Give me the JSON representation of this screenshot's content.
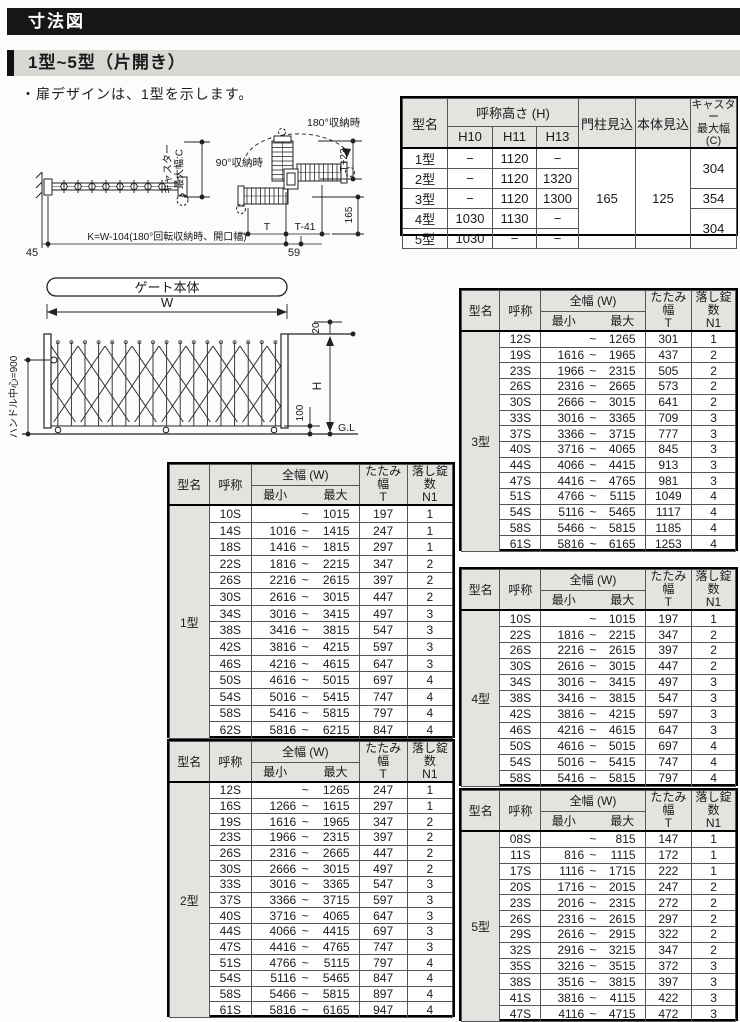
{
  "page": {
    "title": "寸法図",
    "subtitle": "1型~5型（片開き）",
    "note": "・扉デザインは、1型を示します。"
  },
  "plan_view": {
    "caster_l1": "キャスター",
    "caster_l2": "最大幅:C",
    "deg180": "180°収納時",
    "deg90": "90°収納時",
    "t_plus23": "T+23",
    "dim_165": "165",
    "dim_t": "T",
    "dim_t41": "T-41",
    "dim_59": "59",
    "dim_45": "45",
    "k_formula": "K=W-104(180°回転収納時、開口幅)"
  },
  "gate_view": {
    "title": "ゲート本体",
    "w": "W",
    "dim_20": "20",
    "h": "H",
    "dim_100": "100",
    "gl": "G.L",
    "handle_center": "ハンドル中心=900"
  },
  "spec_table": {
    "headers": {
      "model": "型名",
      "height_group": "呼称高さ (H)",
      "h10": "H10",
      "h11": "H11",
      "h13": "H13",
      "pillar": "門柱見込",
      "body": "本体見込",
      "caster": "キャスター\n最大幅\n(C)"
    },
    "rows": [
      {
        "model": "1型",
        "h10": "−",
        "h11": "1120",
        "h13": "−"
      },
      {
        "model": "2型",
        "h10": "−",
        "h11": "1120",
        "h13": "1320"
      },
      {
        "model": "3型",
        "h10": "−",
        "h11": "1120",
        "h13": "1300"
      },
      {
        "model": "4型",
        "h10": "1030",
        "h11": "1130",
        "h13": "−"
      },
      {
        "model": "5型",
        "h10": "1030",
        "h11": "−",
        "h13": "−"
      }
    ],
    "pillar_value": "165",
    "body_value": "125",
    "caster_values": {
      "type12": "304",
      "type3": "354",
      "type45": "304"
    }
  },
  "model_table_headers": {
    "model": "型名",
    "name": "呼称",
    "width_group": "全幅 (W)",
    "min": "最小",
    "max": "最大",
    "tilde": "~",
    "fold": "たたみ幅\nT",
    "lock": "落し錠数\nN1"
  },
  "model_tables": [
    {
      "model": "1型",
      "rows": [
        [
          "10S",
          "",
          "1015",
          "197",
          "1"
        ],
        [
          "14S",
          "1016",
          "1415",
          "247",
          "1"
        ],
        [
          "18S",
          "1416",
          "1815",
          "297",
          "1"
        ],
        [
          "22S",
          "1816",
          "2215",
          "347",
          "2"
        ],
        [
          "26S",
          "2216",
          "2615",
          "397",
          "2"
        ],
        [
          "30S",
          "2616",
          "3015",
          "447",
          "2"
        ],
        [
          "34S",
          "3016",
          "3415",
          "497",
          "3"
        ],
        [
          "38S",
          "3416",
          "3815",
          "547",
          "3"
        ],
        [
          "42S",
          "3816",
          "4215",
          "597",
          "3"
        ],
        [
          "46S",
          "4216",
          "4615",
          "647",
          "3"
        ],
        [
          "50S",
          "4616",
          "5015",
          "697",
          "4"
        ],
        [
          "54S",
          "5016",
          "5415",
          "747",
          "4"
        ],
        [
          "58S",
          "5416",
          "5815",
          "797",
          "4"
        ],
        [
          "62S",
          "5816",
          "6215",
          "847",
          "4"
        ]
      ]
    },
    {
      "model": "2型",
      "rows": [
        [
          "12S",
          "",
          "1265",
          "247",
          "1"
        ],
        [
          "16S",
          "1266",
          "1615",
          "297",
          "1"
        ],
        [
          "19S",
          "1616",
          "1965",
          "347",
          "2"
        ],
        [
          "23S",
          "1966",
          "2315",
          "397",
          "2"
        ],
        [
          "26S",
          "2316",
          "2665",
          "447",
          "2"
        ],
        [
          "30S",
          "2666",
          "3015",
          "497",
          "2"
        ],
        [
          "33S",
          "3016",
          "3365",
          "547",
          "3"
        ],
        [
          "37S",
          "3366",
          "3715",
          "597",
          "3"
        ],
        [
          "40S",
          "3716",
          "4065",
          "647",
          "3"
        ],
        [
          "44S",
          "4066",
          "4415",
          "697",
          "3"
        ],
        [
          "47S",
          "4416",
          "4765",
          "747",
          "3"
        ],
        [
          "51S",
          "4766",
          "5115",
          "797",
          "4"
        ],
        [
          "54S",
          "5116",
          "5465",
          "847",
          "4"
        ],
        [
          "58S",
          "5466",
          "5815",
          "897",
          "4"
        ],
        [
          "61S",
          "5816",
          "6165",
          "947",
          "4"
        ]
      ]
    },
    {
      "model": "3型",
      "rows": [
        [
          "12S",
          "",
          "1265",
          "301",
          "1"
        ],
        [
          "19S",
          "1616",
          "1965",
          "437",
          "2"
        ],
        [
          "23S",
          "1966",
          "2315",
          "505",
          "2"
        ],
        [
          "26S",
          "2316",
          "2665",
          "573",
          "2"
        ],
        [
          "30S",
          "2666",
          "3015",
          "641",
          "2"
        ],
        [
          "33S",
          "3016",
          "3365",
          "709",
          "3"
        ],
        [
          "37S",
          "3366",
          "3715",
          "777",
          "3"
        ],
        [
          "40S",
          "3716",
          "4065",
          "845",
          "3"
        ],
        [
          "44S",
          "4066",
          "4415",
          "913",
          "3"
        ],
        [
          "47S",
          "4416",
          "4765",
          "981",
          "3"
        ],
        [
          "51S",
          "4766",
          "5115",
          "1049",
          "4"
        ],
        [
          "54S",
          "5116",
          "5465",
          "1117",
          "4"
        ],
        [
          "58S",
          "5466",
          "5815",
          "1185",
          "4"
        ],
        [
          "61S",
          "5816",
          "6165",
          "1253",
          "4"
        ]
      ]
    },
    {
      "model": "4型",
      "rows": [
        [
          "10S",
          "",
          "1015",
          "197",
          "1"
        ],
        [
          "22S",
          "1816",
          "2215",
          "347",
          "2"
        ],
        [
          "26S",
          "2216",
          "2615",
          "397",
          "2"
        ],
        [
          "30S",
          "2616",
          "3015",
          "447",
          "2"
        ],
        [
          "34S",
          "3016",
          "3415",
          "497",
          "3"
        ],
        [
          "38S",
          "3416",
          "3815",
          "547",
          "3"
        ],
        [
          "42S",
          "3816",
          "4215",
          "597",
          "3"
        ],
        [
          "46S",
          "4216",
          "4615",
          "647",
          "3"
        ],
        [
          "50S",
          "4616",
          "5015",
          "697",
          "4"
        ],
        [
          "54S",
          "5016",
          "5415",
          "747",
          "4"
        ],
        [
          "58S",
          "5416",
          "5815",
          "797",
          "4"
        ]
      ]
    },
    {
      "model": "5型",
      "rows": [
        [
          "08S",
          "",
          "815",
          "147",
          "1"
        ],
        [
          "11S",
          "816",
          "1115",
          "172",
          "1"
        ],
        [
          "17S",
          "1116",
          "1715",
          "222",
          "1"
        ],
        [
          "20S",
          "1716",
          "2015",
          "247",
          "2"
        ],
        [
          "23S",
          "2016",
          "2315",
          "272",
          "2"
        ],
        [
          "26S",
          "2316",
          "2615",
          "297",
          "2"
        ],
        [
          "29S",
          "2616",
          "2915",
          "322",
          "2"
        ],
        [
          "32S",
          "2916",
          "3215",
          "347",
          "2"
        ],
        [
          "35S",
          "3216",
          "3515",
          "372",
          "3"
        ],
        [
          "38S",
          "3516",
          "3815",
          "397",
          "3"
        ],
        [
          "41S",
          "3816",
          "4115",
          "422",
          "3"
        ],
        [
          "47S",
          "4116",
          "4715",
          "472",
          "3"
        ]
      ]
    }
  ]
}
